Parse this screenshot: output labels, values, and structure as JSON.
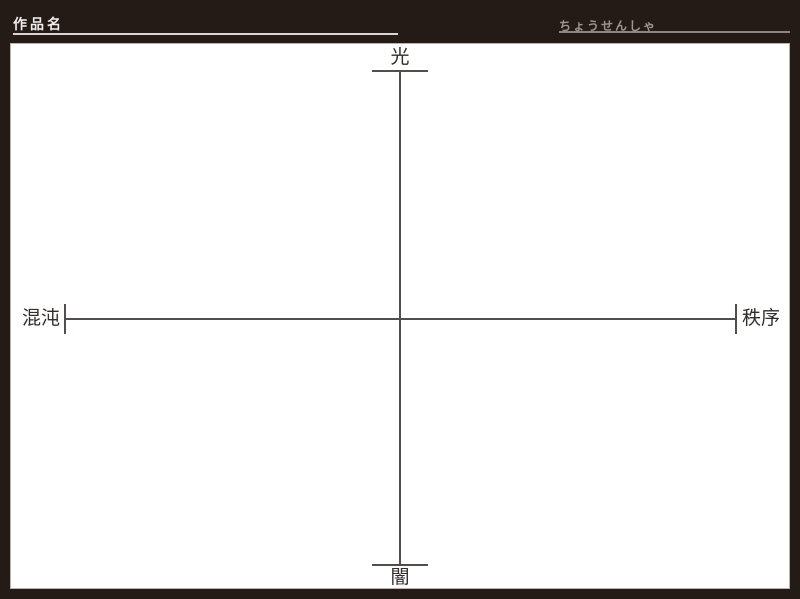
{
  "window": {
    "width": 800,
    "height": 599
  },
  "header": {
    "work_title_label": "作品名",
    "challenger_label": "ちょうせんしゃ"
  },
  "axes": {
    "top_label": "光",
    "bottom_label": "闇",
    "left_label": "混沌",
    "right_label": "秩序"
  },
  "colors": {
    "frame": "#241a16",
    "panel": "#ffffff",
    "panel_edge": "#b7b3b0",
    "axis": "#534e4c",
    "axis_label_text": "#332d2b",
    "header_text": "#f0eeeb",
    "challenger_text": "#9b9694",
    "underline_left": "#d9d6d3",
    "underline_right": "#8b8683"
  }
}
